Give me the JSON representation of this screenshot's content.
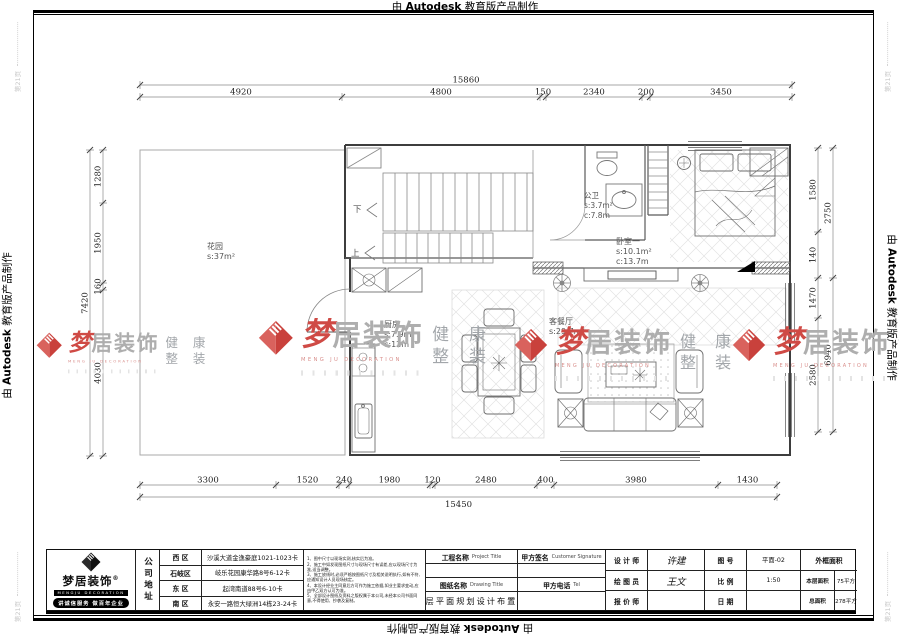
{
  "edge": {
    "prefix": "由",
    "brand": "Autodesk",
    "suffix": "教育版产品制作"
  },
  "corner_mark": "第21页",
  "dimensions": {
    "top": {
      "total": "15860",
      "segments": [
        "4920",
        "4800",
        "150",
        "2340",
        "200",
        "3450"
      ]
    },
    "bottom": {
      "total": "15450",
      "segments": [
        "3300",
        "1520",
        "240",
        "1980",
        "120",
        "2480",
        "400",
        "3980",
        "1430"
      ]
    },
    "left": {
      "total": "7420",
      "segments": [
        "1280",
        "1950",
        "160",
        "4030"
      ]
    },
    "right": {
      "inner": [
        "1580",
        "140",
        "1470",
        "2580"
      ],
      "outer": [
        "2750",
        "6940"
      ]
    }
  },
  "rooms": {
    "garden": {
      "name": "花园",
      "area": "s:37m²"
    },
    "kitchen": {
      "name": "厨房",
      "area": "s:7.9m²",
      "circ": "c:12m"
    },
    "bath": {
      "name": "公卫",
      "area": "s:3.7m²",
      "circ": "c:7.8m"
    },
    "bedroom": {
      "name": "卧室一",
      "area": "s:10.1m²",
      "circ": "c:13.7m"
    },
    "living": {
      "name": "客餐厅",
      "area": "s:29.7m²"
    },
    "stair_up": "上",
    "stair_down": "下"
  },
  "watermark": {
    "meng": "梦",
    "rest": "居装饰",
    "sub": "MENG JU DECORATION",
    "health1": "健 康",
    "health2": "整 装",
    "red": "#cf4a45"
  },
  "titleblock": {
    "logo": {
      "brand": "梦居装饰",
      "reg": "®",
      "sub": "MENGJU DECORATION",
      "slogan": "讲诚信服务 做百年企业"
    },
    "address_header": "公司地址",
    "addresses": [
      {
        "district": "西 区",
        "addr": "沙溪大道金逸豪庭1021-1023卡"
      },
      {
        "district": "石岐区",
        "addr": "岐乐花园康华路8号6-12卡"
      },
      {
        "district": "东 区",
        "addr": "起湾南道88号6-10卡"
      },
      {
        "district": "南 区",
        "addr": "永安一路恒大绿洲14栋23-24卡"
      }
    ],
    "notes": [
      "1、图中尺寸以现场实测,核实后为准。",
      "2、施工中如发现图纸尺寸与现场尺寸有误差,应以现场尺寸为准,适当调整。",
      "3、施工放线时,必须严格按图纸尺寸及相关说明执行,如有不符,应通知设计人员现场核定。",
      "4、本设计经业主同意后方可作为施工依据,如业主要求变动,应由甲乙双方认可为准。",
      "5、全部设计图纸及资料之版权属于本公司,未经本公司书面同意,不得使用、抄袭及复制。"
    ],
    "project_label": "工程名称",
    "project_label_en": "Project Title",
    "drawing_label": "图纸名称",
    "drawing_label_en": "Drawing Title",
    "drawing_name": "一层平面规划设计布置图",
    "customer_sign_label": "甲方签名",
    "customer_sign_en": "Customer Signature",
    "customer_tel_label": "甲方电话",
    "customer_tel_en": "Tel",
    "designer_label": "设 计 师",
    "designer": "许建",
    "drafter_label": "绘 图 员",
    "drafter": "王文",
    "quoter_label": "报 价 师",
    "quoter": "",
    "fig_label": "图  号",
    "fig_no": "平面-02",
    "scale_label": "比  例",
    "scale": "1:50",
    "date_label": "日  期",
    "date": "",
    "frame_area_label": "外框面积",
    "frame_area": "",
    "floor_area_label": "本层面积",
    "floor_area": "75平方",
    "total_area_label": "总面积",
    "total_area": "278平方"
  }
}
